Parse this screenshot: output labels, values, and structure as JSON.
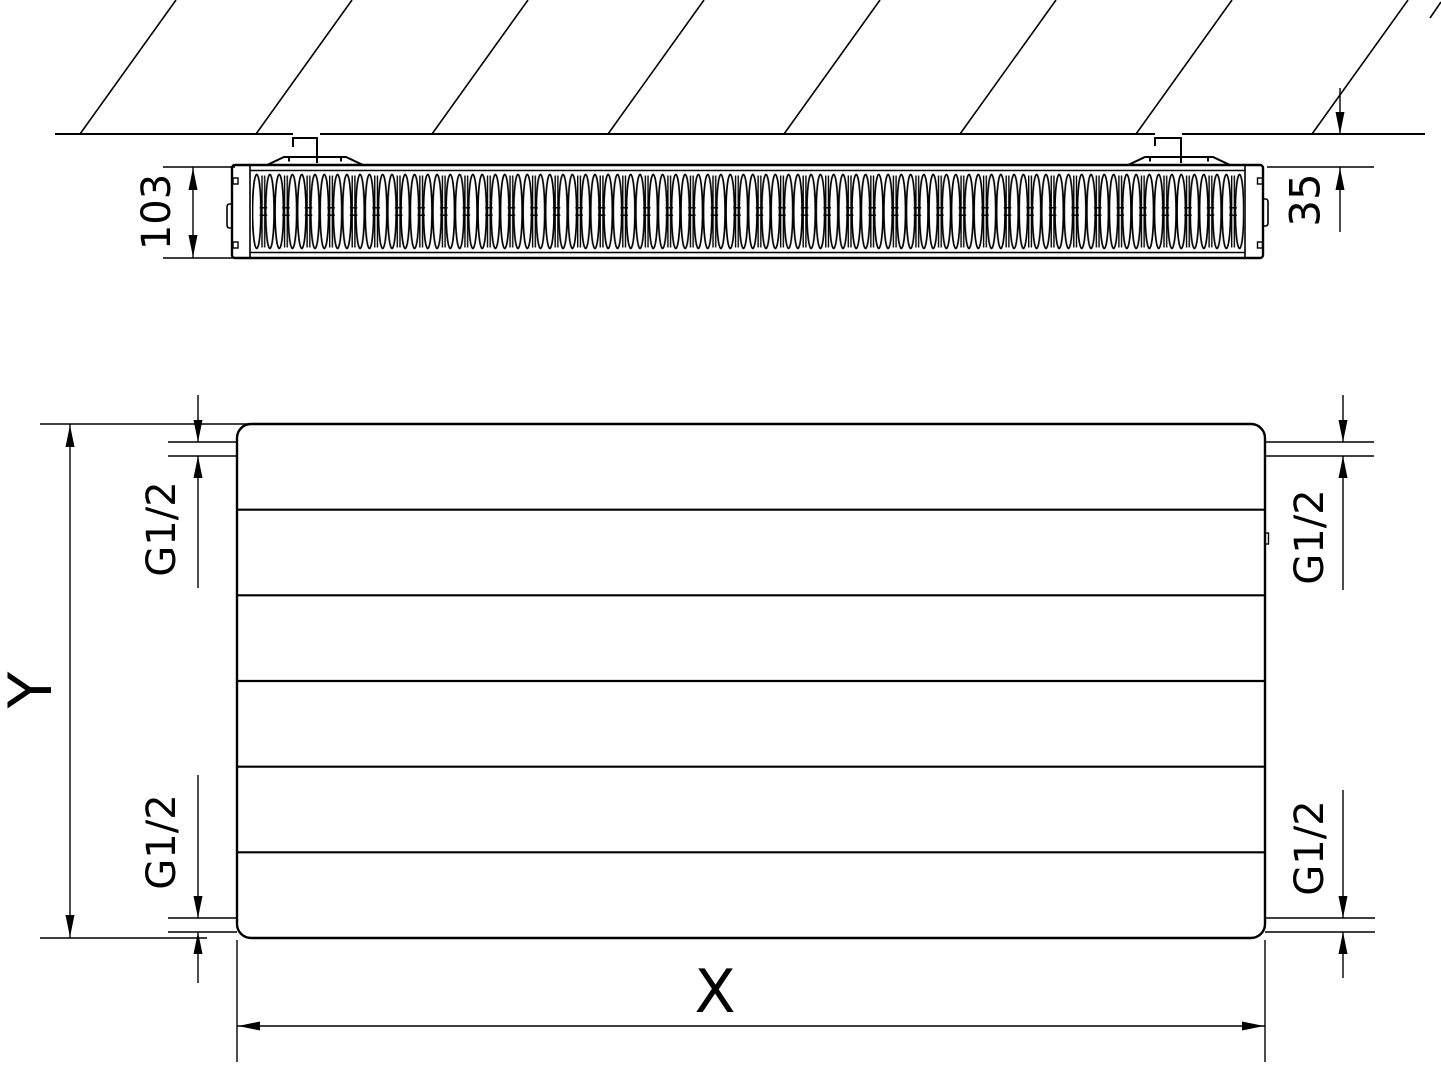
{
  "drawing": {
    "top_view": {
      "depth": "103",
      "wall_distance": "35"
    },
    "front_view": {
      "height": "Y",
      "width": "X",
      "conn_top_left": "G1/2",
      "conn_top_right": "G1/2",
      "conn_bottom_left": "G1/2",
      "conn_bottom_right": "G1/2"
    }
  }
}
